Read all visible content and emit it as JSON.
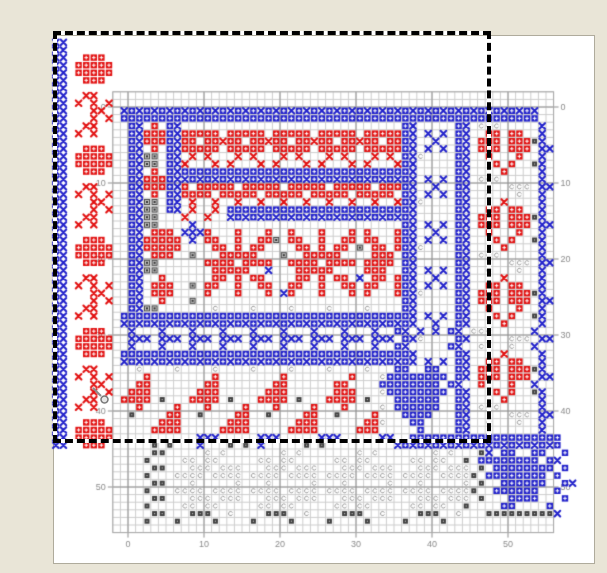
{
  "window": {
    "bg": "#E9E5D7",
    "canvas": {
      "x": 53,
      "y": 35,
      "w": 540,
      "h": 527,
      "bg": "#FFFFFF",
      "border": "#AFAB9C"
    }
  },
  "selection": {
    "x": 55,
    "y": 33,
    "w": 434,
    "h": 408,
    "ant_black": "#000000",
    "ant_white": "#FFFFFF"
  },
  "cursor": {
    "x": 90,
    "y": 385,
    "color": "#888888"
  },
  "chart_data": {
    "type": "heatmap",
    "title": "cross-stitch pattern chart with red/blue motifs, symbol stitches and a dragged marquee selection",
    "grid": {
      "origin_x": 128,
      "origin_y": 107,
      "cell": 7.6,
      "line_min": -2,
      "line_max": 56,
      "minor_color": "#CDCDCD",
      "major_color": "#8F8F8F",
      "edge_color": "#A8A8A8",
      "major_every": 10
    },
    "axis": {
      "tick_labels": [
        "0",
        "10",
        "20",
        "30",
        "40",
        "50"
      ],
      "tick_values": [
        0,
        10,
        20,
        30,
        40,
        50
      ],
      "sides": [
        "left",
        "right",
        "bottom"
      ],
      "color": "#8A8A8A",
      "font_px": 9
    },
    "palette": {
      "R": "#E21212",
      "r": "#E21212",
      "B": "#2323CB",
      "b": "#2323CB",
      "g_fill": "#C2C2C2",
      "g_border": "#4A4A4A",
      "g_dot": "#333333",
      "s_fill": "#3F3F3F",
      "s_dot": "#BBBBBB",
      "c": "#9A9A9A",
      "stitch_dot": "#FFFFFF"
    },
    "cells": {
      "col_start": -10,
      "row_start": -10,
      "legend": {
        ".": "empty",
        "R": "red full stitch",
        "r": "red half stitch x",
        "B": "blue full stitch",
        "b": "blue half stitch x",
        "g": "grey symbol square",
        "s": "dark symbol square",
        "c": "light c symbol"
      },
      "rows": [
        "..................................................................",
        "bb................................................................",
        "bb................................................................",
        "bb..RRR..........................................................",
        "bb.RRRRR.........................................................",
        "bb.RRRRR.........................................................",
        "bb..RRR..........................................................",
        "bb...............................................................",
        "bb..rr...........................................................",
        "bb.r.r.r.........................................................",
        "bb...rr..bBbBbBbBbBbBbBbBbBbBbBbBbBbBbBbBbBbBbBbBbBbBbBbBbBbBbBb",
        "bb...r.r.BBBBBBBBBBBBBBBBBBBBBBBBBBBBBBBBBBBBBBBBBBBBBBBBBBBBBBB",
        "bb..rr....Bb.R.Bb.............................Bb.....Bb.ccc.....b.",
        "bb.r.r....BbRRRBbRRRRR.RRRRR.RRRRR.RRRRR.RRRRRBb.b.b.Bb..RR.RR..b.",
        "bb........BbRRRBbRR.RRrRR.RRrRR.RRrRR.RRrRR.RRBb..b..Bb.RRR.RRRsb.",
        "bb..RRR...Bb.R.BbRRRRR.RRRRR.RRRRR.RRRRR.RRRRRBb.b.b.Bb.RRR.RRR.bb",
        "bb.RRRRR..Bbgg.Bb.r.r...r.r...r.r...r.r...r.r.Bbc....Bb..R...R..b.",
        "bb.RRRRR..Bbgg.Bbr...r.r...r.r...r.r...r.r...rBb.....Bb...R.R..sb.",
        "bb..RRR...Bb.R.BbBBBBBBBBBBBBBBBBBBBBBBBBBBBBBBb.....Bb....R....b.",
        "bb........BbRRRBbbBbBbBbBbBbBbBbBbBbBbBbBbBbBbBb.b.b.Bb.ccc.....b.",
        "bb..rr....BbRRRBbR.RRRRR.RRRRR.RRRRR.RRRRR.RRRBb..b..Bb.....ccc.bb",
        "bb.r.r.r..Bb.R.BbRRRR.RRRRR.RRRRR.RRRRR.RRRRR.Bb.b.b.Bb..c...c..b.",
        "bb...rr...Bbgg.Bb.r..r..r..r..r..r..r..r..r..rBbc....Bb....r....b.",
        "bb...r.r..Bbgg.Bb.r..r.BBBBBBBBBBBBBBBBBBBBBBBBb.....Bb..RR.RR..b.",
        "bb..rr....Bbgg...r..r..bBbBbBbBbBbBbBbBbBbBbBbBb.....Bb.RRR.RRRsb.",
        "bb.r.r....Bbgg....b...........................Bb.b.b.Bb.RRR.RRR.bb",
        "bb........Bb.RRR.bbbR...R...R..R...R...R.R...RBb..b..Bb..R...R..b.",
        "bb..RRR...BbRRRRR.b.RR..R..RRg.RR..R..RR.RR..RBb.b.b.Bb...R.R..sb.",
        "bb.RRRRR..BbRRRRR....RR.R.RR....RR.R.RR.g.RR.RBbc....Bb....R....b.",
        "bb.RRRRR..Bb.RRR..g...RRRRR...g..RRRRR....RRR.Bb.....Bb.ccc.....b.",
        "bb..RRR...Bbgg......RRRR.RRRR..RRRR.RRRR.RRRR.Bb.....Bb.....ccc.bb",
        "bb........Bbgg.......RRRRR..b...RRRRR....RRR..Bb.b.b.Bb..c...c..b.",
        "bb..rr....Bb..R......RR.R.RR....RR.R.RR.b.RR.RBb..b..Bb....r....b.",
        "bb.r.r.r..Bb.RRR..g.RR..R..RR..RR..R..RR.RR..RBb.b.b.Bb..RR.RR..b.",
        "bb...rr...Bb.RRR....R...R...R.bR...R...R.R...RBbc....Bb.RRR.RRRsb.",
        "bb...r.r..Bb..R...g...........................Bb.....Bb.RRR.RRR.bb",
        "bb..rr....Bbgg.......c....c....c....c....c....Bb.....Bb..R...R..b.",
        "bb.r.r...BBBBBBBBBBBBBBBBBBBBBBBBBBBBBBBBBBBBBBb.b.b.Bb...R.R..sb.",
        "bb.......bBbBbBbBbBbBbBbBbBbBbBbBbBbBbBbBbBbBbBb..b..Bb....R....b.",
        "bb..RRR...b...b...b...b...b...b...b...b...b..Bb.b.b.Bb.ccc.....b.",
        "bb.RRRRR..bbb.bbb.bbb.bbb.bbb.bbb.bbb.bbb.bbb.Bbc....Bb.....ccc.bb",
        "bb.RRRRR..b...b...b...b...b...b...b...b...b..Bb.....Bb..c...c..b.",
        "bb..RRR..BBBBBBBBBBBBBBBBBBBBBBBBBBBBBBBBBBBBBBb.....Bb....r....b.",
        "bb.......bBbBbBbBbBbBbBbBbBbBbBbBbBbBbBbBbBbBbBb.b.b.Bb..RR.RR..b.",
        "bb..rr.....c....c....c....c....c....c....c...BB..BB..Bb.RRR.RRRsb.",
        "bb.r.r.r....R........R........R........R...cBBBBBBBB.Bb.RRR.RRR.bb",
        "bb...rr....RR.......RR.......RR......RR....BBBBBBBB.Bb..R...R..b.",
        "bb...r.r..RRR......RRR......RRR......RRR...cBBBBBBBB.Bb...R.R..sb.",
        "bb..rr...RRRR.s...RRRR.s...RRRR.s...RRRR.s...BBBBBB..Bb....R....b.",
        "bb.r.r.....R....R...R....R...R....R...R....c.BBBBBB..Bb.ccc.....b.",
        "bb........s....RR..s....RR..s....RR..s....R...BBBB...Bb.....ccc.bb",
        "bb..RRR.......RRR......RRR......RRR......RRc...BB....Bb..c...c..b.",
        "bb.RRRRR.....RRRR.....RRRR.....RRRR.....RRR.....B....Bb.........b.",
        "bb.RRRRR...........bbb.....bbb.....bbb.....bb..BBBBBBBBBBBBBBBBBBBB",
        "bb..RRR......s.s...b...s.s.b.....s.s.........bBbBbBbBbBbBbBbBbBbBbB",
        ".............ss.....c.c.......c.c.......c.c.......c.c...sb.BB..BB..B.",
        "............s....cc.cc.....cc.cc.....cc.cc.....cc.cc..s.BBBBBBBB.Bb",
        ".............ss...ccc.ccc...ccc.ccc...ccc.ccc...ccc.ccc.s.BBBBBBBB.B.",
        "............s...cccc.cccc.cccc.cccc.cccc.cccc.cccc.ccccs.BBBBBBBB.B.",
        ".............ss...c.....c...c.....c...c.....c...c.....c.s..BBBBBB..Bb",
        "............s...cccc.cccc.cccc.cccc.cccc.cccc.cccc.ccccs..BBBBBB..B.",
        ".............ss...ccc.ccc...ccc.ccc...ccc.ccc...ccc.ccc.s...BBBB...B.",
        "............s....cc.cc.....cc.cc.....cc.cc.....cc.cc..s....BB....B.",
        ".............ss...sss..c....sss..c....sss..c....sss..c...sssssssssb.",
        "............s...s....s....s....s....s....s....s....s.................",
        ".................................................................."
      ]
    }
  }
}
